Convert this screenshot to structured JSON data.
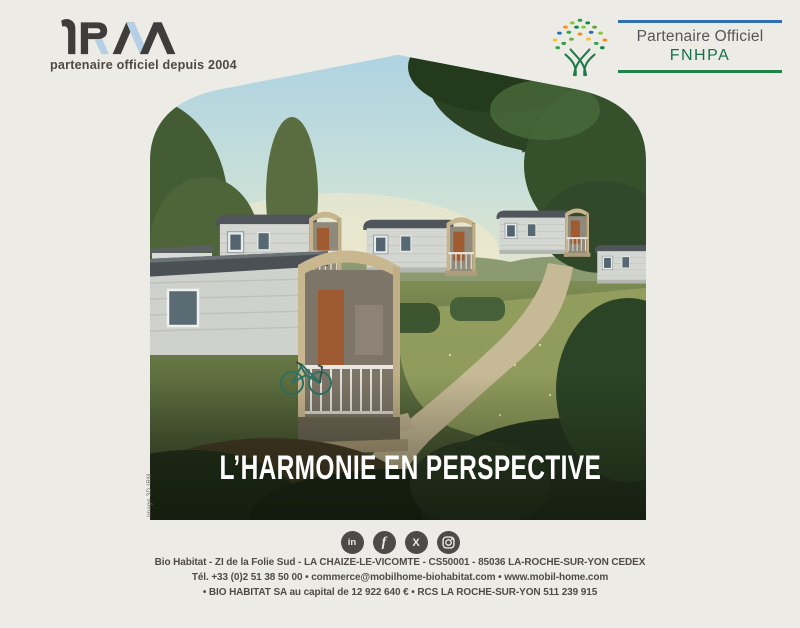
{
  "brand": {
    "logo_text": "iRM",
    "tagline": "partenaire officiel depuis 2004",
    "colors": {
      "logo_dark": "#3e3d3c",
      "logo_blue": "#b5cfe4",
      "background": "#edebe5"
    }
  },
  "partner_badge": {
    "line1": "Partenaire Officiel",
    "line2": "FNHPA",
    "colors": {
      "rule_top_blue": "#2f6eb0",
      "rule_bottom_green": "#1e8149",
      "fnhpa_green": "#15714a"
    }
  },
  "hero": {
    "headline": "L’HARMONIE EN PERSPECTIVE",
    "credit": "Image 3D IRM"
  },
  "social": {
    "linkedin": "in",
    "facebook": "f",
    "x": "X"
  },
  "footer": {
    "line1": "Bio Habitat - ZI de la Folie Sud - LA CHAIZE-LE-VICOMTE - CS50001 - 85036 LA-ROCHE-SUR-YON CEDEX",
    "line2": "Tél. +33 (0)2 51 38 50 00 • commerce@mobilhome-biohabitat.com • www.mobil-home.com",
    "line3": "• BIO HABITAT SA au capital de 12 922 640 € • RCS LA ROCHE-SUR-YON 511 239 915"
  }
}
